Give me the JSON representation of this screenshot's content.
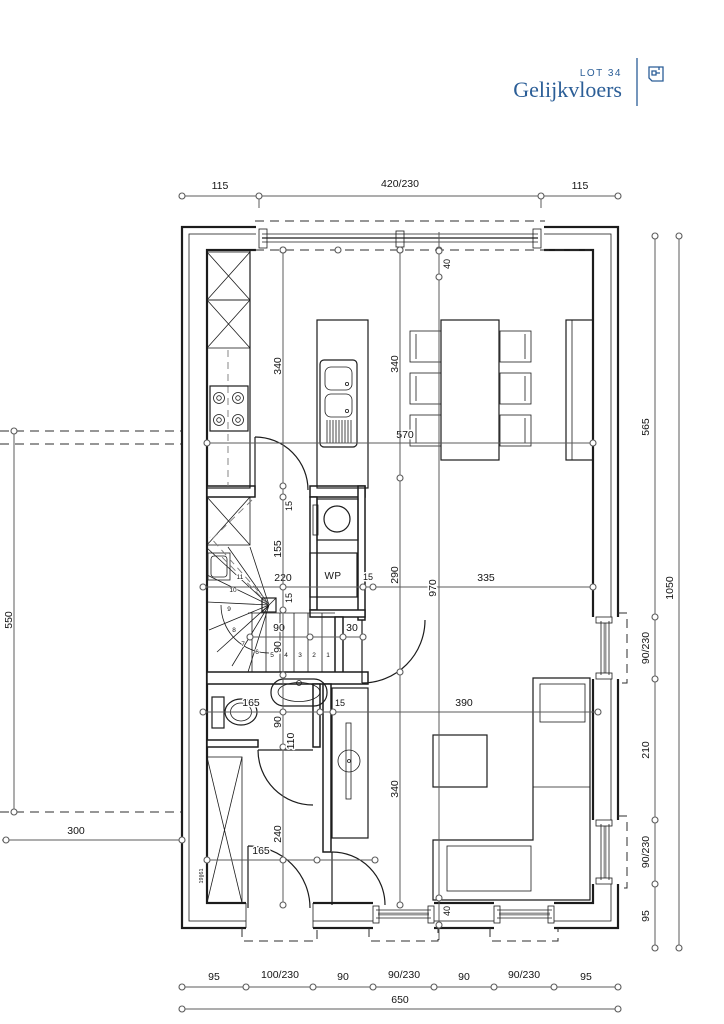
{
  "header": {
    "lot": "LOT 34",
    "title": "Gelijkvloers"
  },
  "colors": {
    "accent": "#2b5e97",
    "line": "#1c1c1c",
    "dim": "#5b5b5b"
  },
  "dims": {
    "top": [
      "115",
      "420/230",
      "115"
    ],
    "bottom": [
      "95",
      "100/230",
      "90",
      "90/230",
      "90",
      "90/230",
      "95"
    ],
    "bottom_total": "650",
    "right": [
      "565",
      "90/230",
      "210",
      "90/230",
      "95"
    ],
    "right_total": "1050",
    "carport_height": "550",
    "carport_width": "300",
    "interior": {
      "kitchen_width": "570",
      "stair_width": "220",
      "wall_a": "15",
      "living_width": "335",
      "stair_run": "90",
      "stair_gap": "30",
      "wc_width": "165",
      "wall_d": "15",
      "living_w2": "390",
      "hall_width": "165",
      "kitchen_depth": "340",
      "wall_b": "15",
      "stair_depth": "155",
      "wall_c": "15",
      "stair_well": "90",
      "wc_basin": "90",
      "wc_depth": "110",
      "hall_depth": "240",
      "seg_340a": "340",
      "seg_290": "290",
      "seg_340b": "340",
      "off_40_top": "40",
      "total_970": "970",
      "off_40_bottom": "40"
    }
  },
  "rooms": {
    "wp": "WP"
  },
  "stairs": {
    "numbers": [
      "1",
      "2",
      "3",
      "4",
      "5",
      "6",
      "7",
      "8",
      "9",
      "10",
      "11"
    ]
  },
  "annotations": {
    "closet": "19||61"
  }
}
